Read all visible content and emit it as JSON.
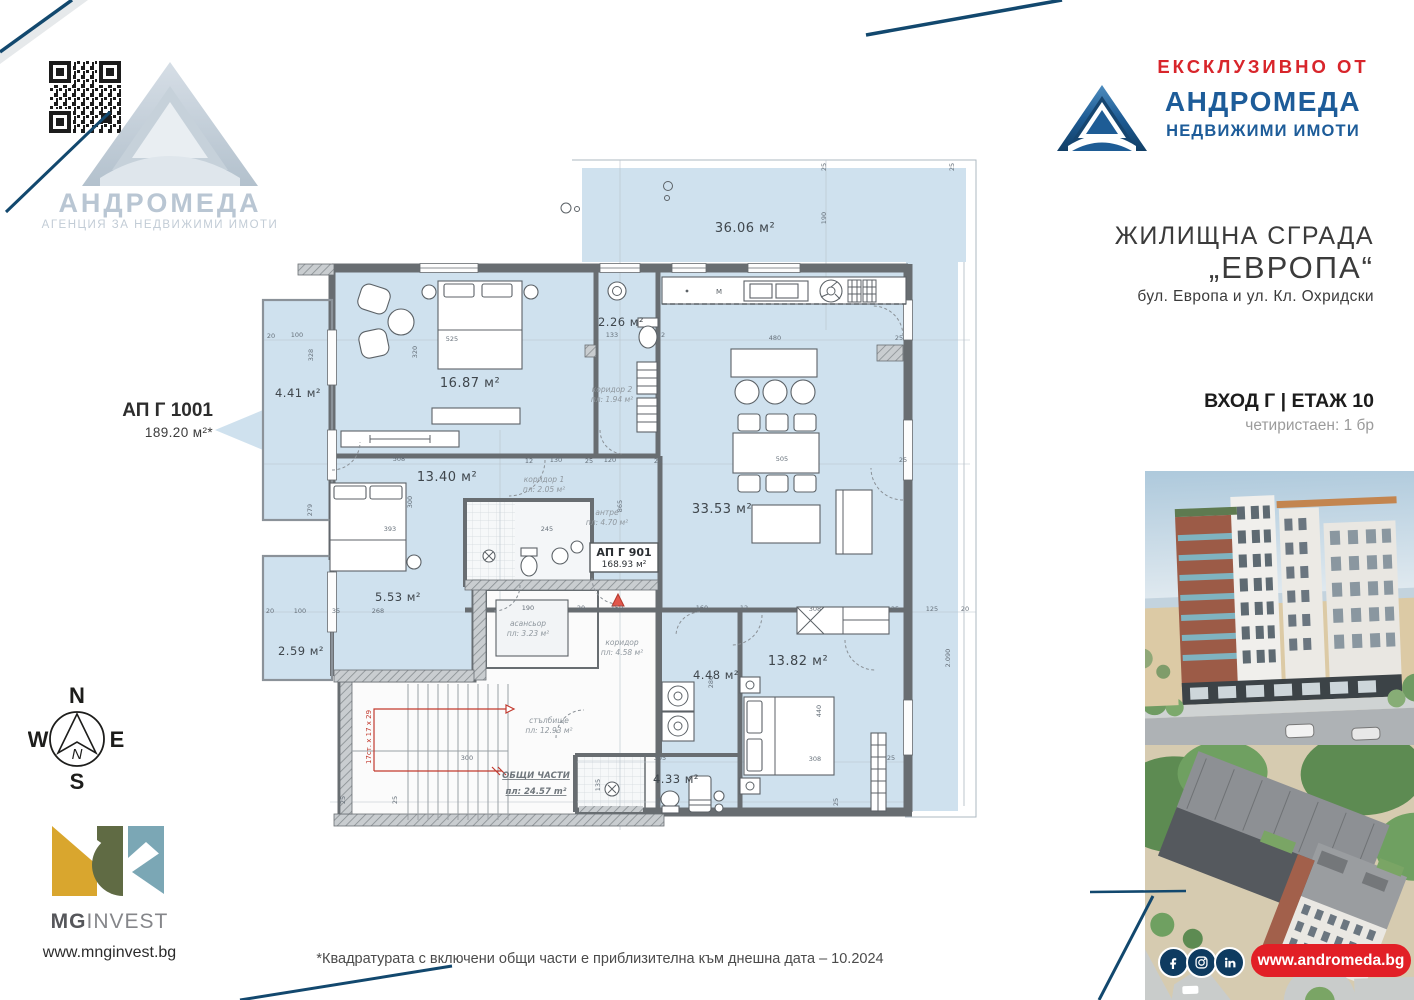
{
  "watermark": {
    "brand_name": "АНДРОМЕДА",
    "brand_subtitle": "АГЕНЦИЯ ЗА НЕДВИЖИМИ ИМОТИ"
  },
  "header": {
    "exclusive_label": "ЕКСКЛУЗИВНО ОТ",
    "brand_name": "АНДРОМЕДА",
    "brand_subtitle": "НЕДВИЖИМИ ИМОТИ"
  },
  "building": {
    "type_line": "ЖИЛИЩНА СГРАДА",
    "name_line": "„ЕВРОПА“",
    "address_line": "бул. Европа и ул. Кл. Охридски",
    "entrance_floor": "ВХОД Г | ЕТАЖ 10",
    "availability": "четиристаен: 1 бр"
  },
  "callout": {
    "unit_id": "АП Г 1001",
    "unit_area": "189.20 м²*"
  },
  "plan": {
    "unit_box": {
      "id": "АП Г 901",
      "area": "168.93 м²"
    },
    "areas": {
      "terrace": "36.06 м²",
      "balcony1": "4.41 м²",
      "bedroom1": "16.87 м²",
      "wc": "2.26 м²",
      "bedroom2": "13.40 м²",
      "living": "33.53 м²",
      "wardrobe": "5.53 м²",
      "balcony2": "2.59 м²",
      "laundry": "4.48 м²",
      "bedroom3": "13.82 м²",
      "bathroom2": "4.33 м²"
    },
    "small_labels": {
      "corridor2": {
        "name": "коридор 2",
        "area": "пл: 1.94 м²"
      },
      "corridor1": {
        "name": "коридор 1",
        "area": "пл: 2.05 м²"
      },
      "entry": {
        "name": "антре",
        "area": "пл: 4.70 м²"
      },
      "elevator": {
        "name": "асансьор",
        "area": "пл: 3.23 м²"
      },
      "stairwell": {
        "name": "стълбище",
        "area": "пл: 12.93 м²"
      },
      "common": {
        "name": "ОБЩИ ЧАСТИ",
        "area": "пл:  24.57 m²"
      },
      "corridor3": {
        "name": "коридор",
        "area": "пл: 4.58 м²"
      }
    },
    "stairs_note": "17ст. x 17 x 29",
    "kitchen_mark": "M",
    "dims": [
      "25",
      "190",
      "25",
      "525",
      "320",
      "20",
      "100",
      "328",
      "133",
      "12",
      "480",
      "25",
      "508",
      "12",
      "130",
      "25",
      "120",
      "25",
      "505",
      "25",
      "300",
      "279",
      "393",
      "245",
      "865",
      "20",
      "100",
      "35",
      "268",
      "190",
      "20",
      "150",
      "160",
      "12",
      "308",
      "35",
      "125",
      "20",
      "280",
      "440",
      "305",
      "135",
      "308",
      "25",
      "300",
      "25",
      "25",
      "25",
      "25",
      "2.090"
    ]
  },
  "compass": {
    "north": "N",
    "east": "E",
    "south": "S",
    "west": "W",
    "inner": "N"
  },
  "developer": {
    "name_bold": "MG",
    "name_rest": "INVEST",
    "website": "www.mnginvest.bg"
  },
  "footer": {
    "disclaimer": "*Квадратурата с включени общи части е приблизителна към днешна дата – 10.2024"
  },
  "agency": {
    "website": "www.andromeda.bg"
  },
  "colors": {
    "brand_blue": "#1d5c99",
    "accent_red": "#e21f26",
    "plan_fill": "#cfe1ee",
    "navy_line": "#12486e"
  }
}
